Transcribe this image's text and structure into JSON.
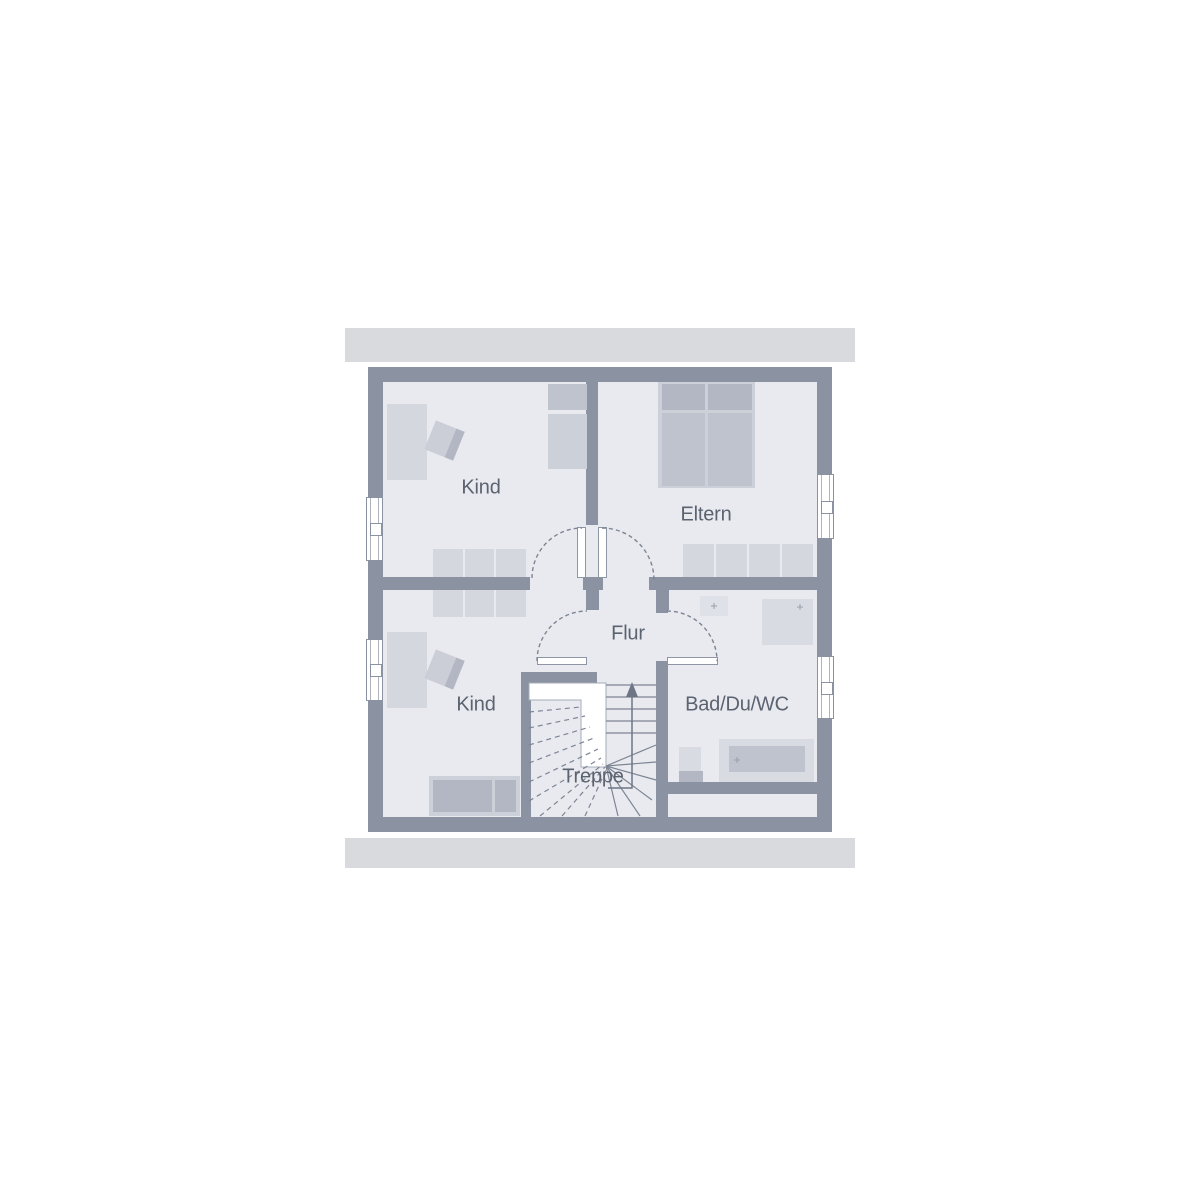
{
  "rooms": {
    "kind_top": {
      "label": "Kind"
    },
    "eltern": {
      "label": "Eltern"
    },
    "flur": {
      "label": "Flur"
    },
    "kind_bottom": {
      "label": "Kind"
    },
    "treppe": {
      "label": "Treppe"
    },
    "bad": {
      "label": "Bad/Du/WC"
    }
  },
  "colors": {
    "wall": "#8b93a3",
    "floor": "#e8eaef",
    "overhang-bar": "#d9dade",
    "line": "#7d8594",
    "text": "#5c6370",
    "furniture-light": "#d5d7de",
    "furniture-outer": "#ccd0d8",
    "furniture-mid": "#bfc3cd",
    "furniture-dark": "#b3b7c3",
    "fixture": "#d9dbe2",
    "fixture-light": "#dfe1e8",
    "white": "#ffffff"
  }
}
